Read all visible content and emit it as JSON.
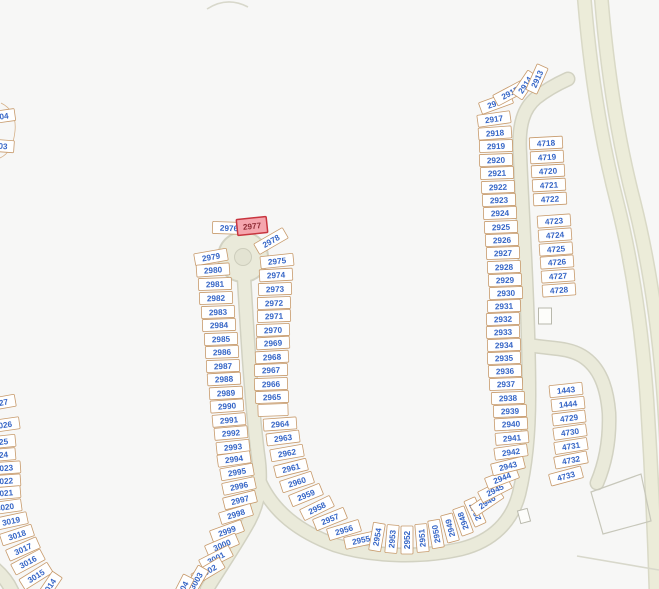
{
  "map": {
    "type": "parcel-map",
    "selected_lot": "2977",
    "colors": {
      "background": "#f7f7f6",
      "road-fill": "#eaeada",
      "road-casing": "#d2d2c2",
      "highway-fill": "#ececd9",
      "highway-casing": "#d9d9c6",
      "lot-fill": "#ffffff",
      "lot-stroke": "#c79a6b",
      "lot-label": "#3565c6",
      "hl-fill": "#f5a6ae",
      "hl-stroke": "#c8353f",
      "hl-label": "#8f2d36",
      "building-stroke": "#b8b8ac",
      "island-fill": "#e3e3d2",
      "island-stroke": "#cdcdbc"
    }
  },
  "lots": [
    {
      "n": "04",
      "x": 4,
      "y": 116,
      "r": -8,
      "w": 22
    },
    {
      "n": "03",
      "x": 3,
      "y": 146,
      "r": 4,
      "w": 22
    },
    {
      "n": "2976",
      "x": 229,
      "y": 228,
      "r": 2
    },
    {
      "n": "2977",
      "x": 252,
      "y": 226,
      "r": -6,
      "hl": true,
      "w": 30,
      "h": 16
    },
    {
      "n": "2978",
      "x": 271,
      "y": 241,
      "r": -30
    },
    {
      "n": "2979",
      "x": 211,
      "y": 257,
      "r": -10
    },
    {
      "n": "2980",
      "x": 213,
      "y": 270,
      "r": -4
    },
    {
      "n": "2981",
      "x": 215,
      "y": 284,
      "r": -2
    },
    {
      "n": "2982",
      "x": 216,
      "y": 298,
      "r": -2
    },
    {
      "n": "2983",
      "x": 218,
      "y": 312,
      "r": -2
    },
    {
      "n": "2984",
      "x": 219,
      "y": 325,
      "r": -2
    },
    {
      "n": "2985",
      "x": 221,
      "y": 339,
      "r": -2
    },
    {
      "n": "2986",
      "x": 222,
      "y": 352,
      "r": -2
    },
    {
      "n": "2987",
      "x": 223,
      "y": 366,
      "r": -2
    },
    {
      "n": "2988",
      "x": 224,
      "y": 379,
      "r": -3
    },
    {
      "n": "2989",
      "x": 226,
      "y": 393,
      "r": -3
    },
    {
      "n": "2990",
      "x": 227,
      "y": 406,
      "r": -4
    },
    {
      "n": "2991",
      "x": 229,
      "y": 420,
      "r": -5
    },
    {
      "n": "2992",
      "x": 231,
      "y": 433,
      "r": -5
    },
    {
      "n": "2993",
      "x": 233,
      "y": 447,
      "r": -6
    },
    {
      "n": "2994",
      "x": 234,
      "y": 459,
      "r": -8
    },
    {
      "n": "2995",
      "x": 237,
      "y": 472,
      "r": -10
    },
    {
      "n": "2996",
      "x": 239,
      "y": 486,
      "r": -12
    },
    {
      "n": "2997",
      "x": 240,
      "y": 500,
      "r": -14
    },
    {
      "n": "2998",
      "x": 236,
      "y": 514,
      "r": -17
    },
    {
      "n": "2999",
      "x": 227,
      "y": 531,
      "r": -20
    },
    {
      "n": "3000",
      "x": 222,
      "y": 545,
      "r": -23
    },
    {
      "n": "3001",
      "x": 216,
      "y": 558,
      "r": -27
    },
    {
      "n": "3002",
      "x": 208,
      "y": 571,
      "r": -31
    },
    {
      "n": "3003",
      "x": 196,
      "y": 581,
      "r": -60,
      "w": 30
    },
    {
      "n": "3004",
      "x": 182,
      "y": 590,
      "r": -63,
      "w": 30
    },
    {
      "n": "2975",
      "x": 277,
      "y": 261,
      "r": -6
    },
    {
      "n": "2974",
      "x": 276,
      "y": 275,
      "r": -3
    },
    {
      "n": "2973",
      "x": 275,
      "y": 289,
      "r": -2
    },
    {
      "n": "2972",
      "x": 274,
      "y": 303,
      "r": -2
    },
    {
      "n": "2971",
      "x": 274,
      "y": 316,
      "r": -2
    },
    {
      "n": "2970",
      "x": 273,
      "y": 330,
      "r": -2
    },
    {
      "n": "2969",
      "x": 273,
      "y": 343,
      "r": -3
    },
    {
      "n": "2968",
      "x": 272,
      "y": 357,
      "r": -3
    },
    {
      "n": "2967",
      "x": 271,
      "y": 370,
      "r": -2
    },
    {
      "n": "2966",
      "x": 271,
      "y": 384,
      "r": -2
    },
    {
      "n": "2965",
      "x": 272,
      "y": 397,
      "r": -2
    },
    {
      "n": "",
      "x": 273,
      "y": 410,
      "r": -2,
      "w": 30
    },
    {
      "n": "2964",
      "x": 280,
      "y": 424,
      "r": -4
    },
    {
      "n": "2963",
      "x": 283,
      "y": 438,
      "r": -7
    },
    {
      "n": "2962",
      "x": 287,
      "y": 453,
      "r": -10
    },
    {
      "n": "2961",
      "x": 291,
      "y": 468,
      "r": -14
    },
    {
      "n": "2960",
      "x": 297,
      "y": 482,
      "r": -18
    },
    {
      "n": "2959",
      "x": 306,
      "y": 495,
      "r": -22
    },
    {
      "n": "2958",
      "x": 317,
      "y": 508,
      "r": -26
    },
    {
      "n": "2957",
      "x": 330,
      "y": 519,
      "r": -22
    },
    {
      "n": "2956",
      "x": 344,
      "y": 530,
      "r": -17
    },
    {
      "n": "2955",
      "x": 361,
      "y": 540,
      "r": -12
    },
    {
      "n": "2954",
      "x": 377,
      "y": 537,
      "r": -80,
      "w": 28
    },
    {
      "n": "2953",
      "x": 392,
      "y": 539,
      "r": -85,
      "w": 28
    },
    {
      "n": "2952",
      "x": 407,
      "y": 540,
      "r": -90,
      "w": 28
    },
    {
      "n": "2951",
      "x": 422,
      "y": 538,
      "r": -95,
      "w": 28
    },
    {
      "n": "2950",
      "x": 436,
      "y": 534,
      "r": -100,
      "w": 28
    },
    {
      "n": "2949",
      "x": 450,
      "y": 528,
      "r": -105,
      "w": 28
    },
    {
      "n": "2948",
      "x": 463,
      "y": 521,
      "r": -110,
      "w": 28
    },
    {
      "n": "2947",
      "x": 475,
      "y": 512,
      "r": -114,
      "w": 28
    },
    {
      "n": "2946",
      "x": 487,
      "y": 502,
      "r": -34
    },
    {
      "n": "2945",
      "x": 495,
      "y": 490,
      "r": -27
    },
    {
      "n": "2944",
      "x": 502,
      "y": 478,
      "r": -21
    },
    {
      "n": "2943",
      "x": 508,
      "y": 466,
      "r": -14
    },
    {
      "n": "2942",
      "x": 511,
      "y": 452,
      "r": -8
    },
    {
      "n": "2941",
      "x": 512,
      "y": 438,
      "r": -5
    },
    {
      "n": "2940",
      "x": 511,
      "y": 424,
      "r": -3
    },
    {
      "n": "2939",
      "x": 510,
      "y": 411,
      "r": -2
    },
    {
      "n": "2938",
      "x": 508,
      "y": 398,
      "r": -2
    },
    {
      "n": "2937",
      "x": 506,
      "y": 384,
      "r": -2
    },
    {
      "n": "2936",
      "x": 505,
      "y": 371,
      "r": -2
    },
    {
      "n": "2935",
      "x": 504,
      "y": 358,
      "r": -2
    },
    {
      "n": "2934",
      "x": 504,
      "y": 345,
      "r": -2
    },
    {
      "n": "2933",
      "x": 503,
      "y": 332,
      "r": -2
    },
    {
      "n": "2932",
      "x": 503,
      "y": 319,
      "r": -2
    },
    {
      "n": "2931",
      "x": 504,
      "y": 306,
      "r": -2
    },
    {
      "n": "2930",
      "x": 506,
      "y": 293,
      "r": -2
    },
    {
      "n": "2929",
      "x": 505,
      "y": 280,
      "r": -2
    },
    {
      "n": "2928",
      "x": 504,
      "y": 267,
      "r": -2
    },
    {
      "n": "2927",
      "x": 503,
      "y": 253,
      "r": -2
    },
    {
      "n": "2926",
      "x": 502,
      "y": 240,
      "r": -2
    },
    {
      "n": "2925",
      "x": 501,
      "y": 227,
      "r": -2
    },
    {
      "n": "2924",
      "x": 500,
      "y": 213,
      "r": -2
    },
    {
      "n": "2923",
      "x": 499,
      "y": 200,
      "r": -2
    },
    {
      "n": "2922",
      "x": 498,
      "y": 187,
      "r": -2
    },
    {
      "n": "2921",
      "x": 497,
      "y": 173,
      "r": -2
    },
    {
      "n": "2920",
      "x": 496,
      "y": 160,
      "r": -2
    },
    {
      "n": "2919",
      "x": 496,
      "y": 146,
      "r": -2
    },
    {
      "n": "2918",
      "x": 495,
      "y": 133,
      "r": -4
    },
    {
      "n": "2917",
      "x": 494,
      "y": 119,
      "r": -8
    },
    {
      "n": "2916",
      "x": 496,
      "y": 103,
      "r": -20
    },
    {
      "n": "2915",
      "x": 510,
      "y": 93,
      "r": -28
    },
    {
      "n": "2914",
      "x": 525,
      "y": 85,
      "r": -56,
      "w": 28
    },
    {
      "n": "2913",
      "x": 537,
      "y": 79,
      "r": -66,
      "w": 28
    },
    {
      "n": "4718",
      "x": 546,
      "y": 143,
      "r": -3
    },
    {
      "n": "4719",
      "x": 547,
      "y": 157,
      "r": -3
    },
    {
      "n": "4720",
      "x": 548,
      "y": 171,
      "r": -3
    },
    {
      "n": "4721",
      "x": 549,
      "y": 185,
      "r": -3
    },
    {
      "n": "4722",
      "x": 550,
      "y": 199,
      "r": -3
    },
    {
      "n": "4723",
      "x": 554,
      "y": 221,
      "r": -4
    },
    {
      "n": "4724",
      "x": 555,
      "y": 235,
      "r": -4
    },
    {
      "n": "4725",
      "x": 556,
      "y": 249,
      "r": -4
    },
    {
      "n": "4726",
      "x": 557,
      "y": 262,
      "r": -4
    },
    {
      "n": "4727",
      "x": 558,
      "y": 276,
      "r": -4
    },
    {
      "n": "4728",
      "x": 559,
      "y": 290,
      "r": -4
    },
    {
      "n": "1443",
      "x": 566,
      "y": 390,
      "r": -6
    },
    {
      "n": "1444",
      "x": 568,
      "y": 404,
      "r": -6
    },
    {
      "n": "4729",
      "x": 569,
      "y": 418,
      "r": -7
    },
    {
      "n": "4730",
      "x": 570,
      "y": 432,
      "r": -8
    },
    {
      "n": "4731",
      "x": 571,
      "y": 446,
      "r": -9
    },
    {
      "n": "4732",
      "x": 571,
      "y": 460,
      "r": -11
    },
    {
      "n": "4733",
      "x": 566,
      "y": 476,
      "r": -15
    },
    {
      "n": "3027",
      "x": -1,
      "y": 403,
      "r": -10
    },
    {
      "n": "3026",
      "x": 3,
      "y": 425,
      "r": -8
    },
    {
      "n": "3025",
      "x": -1,
      "y": 442,
      "r": -6
    },
    {
      "n": "3024",
      "x": -1,
      "y": 455,
      "r": -5
    },
    {
      "n": "3023",
      "x": 4,
      "y": 468,
      "r": -4
    },
    {
      "n": "3022",
      "x": 4,
      "y": 481,
      "r": -4
    },
    {
      "n": "3021",
      "x": 4,
      "y": 493,
      "r": -5
    },
    {
      "n": "3020",
      "x": 5,
      "y": 507,
      "r": -8
    },
    {
      "n": "3019",
      "x": 11,
      "y": 521,
      "r": -12
    },
    {
      "n": "3018",
      "x": 17,
      "y": 535,
      "r": -18
    },
    {
      "n": "3017",
      "x": 23,
      "y": 549,
      "r": -24
    },
    {
      "n": "3016",
      "x": 28,
      "y": 562,
      "r": -28
    },
    {
      "n": "3015",
      "x": 36,
      "y": 576,
      "r": -32
    },
    {
      "n": "3014",
      "x": 49,
      "y": 587,
      "r": -56,
      "w": 30
    }
  ],
  "buildings": [
    {
      "x": 545,
      "y": 316,
      "w": 13,
      "h": 16,
      "r": 0
    },
    {
      "x": 524,
      "y": 516,
      "w": 10,
      "h": 13,
      "r": -15
    }
  ],
  "parcel_outline": "591,492 641,474 651,521 603,534"
}
